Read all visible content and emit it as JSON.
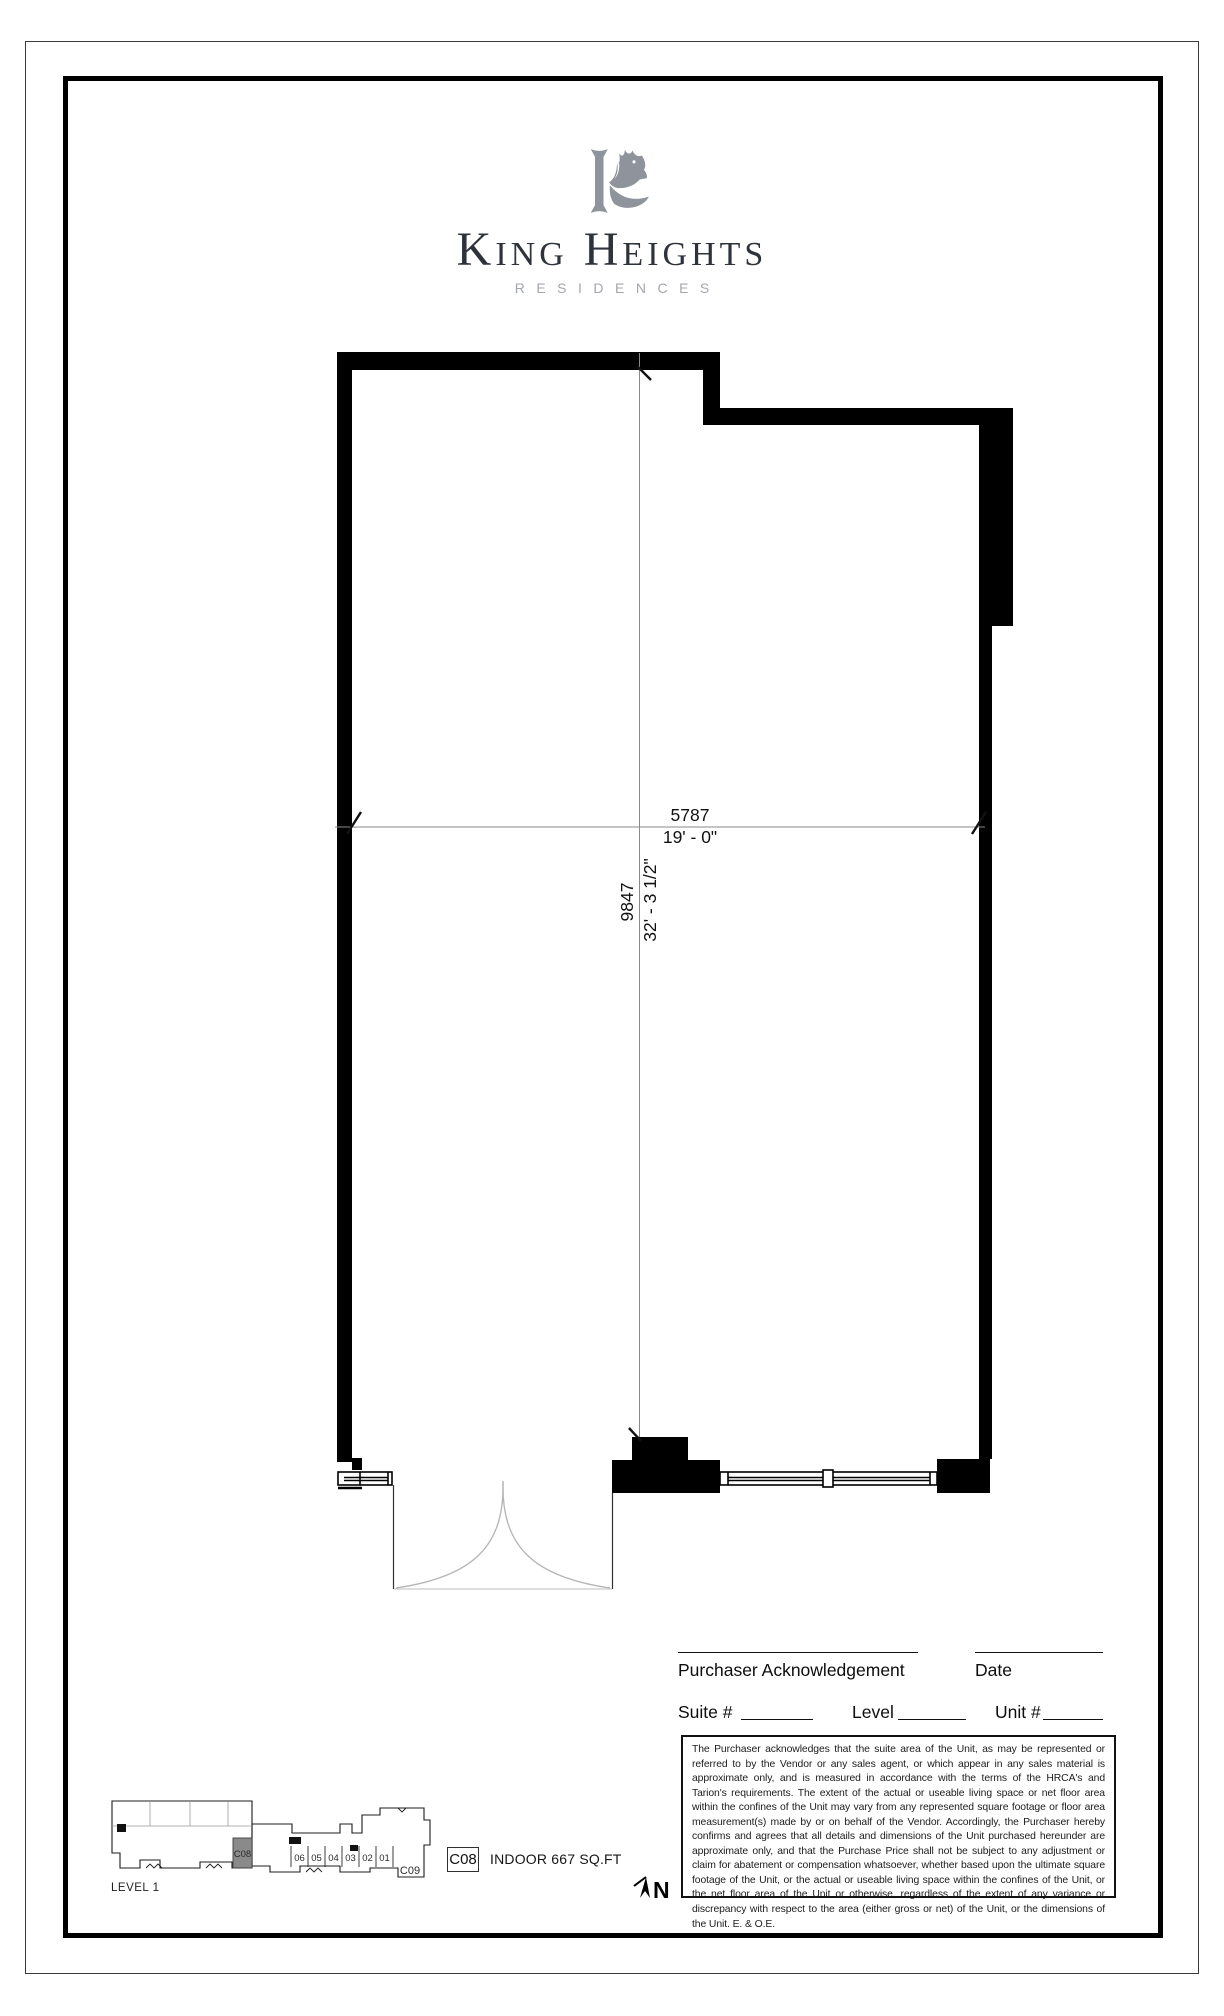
{
  "brand": {
    "name": "King Heights",
    "tagline": "RESIDENCES",
    "logo_icon": "horse-head-k-monogram"
  },
  "floorplan": {
    "dim_horizontal": {
      "mm": "5787",
      "imperial": "19' - 0\""
    },
    "dim_vertical": {
      "mm": "9847",
      "imperial": "32' - 3 1/2\""
    }
  },
  "acknowledgement": {
    "purchaser_label": "Purchaser Acknowledgement",
    "date_label": "Date",
    "suite_label": "Suite #",
    "level_label": "Level",
    "unit_label": "Unit #",
    "disclaimer": "The Purchaser acknowledges that the suite area of the Unit, as may be represented or referred to by the Vendor or any sales agent, or which appear in any sales material is approximate only, and is measured in accordance with the terms of the HRCA's and Tarion's requirements.  The extent of the actual or useable living space or net floor area within the confines of the Unit may vary from any represented square footage or floor area measurement(s) made by or on behalf of the Vendor.  Accordingly, the Purchaser hereby confirms and agrees that all details and dimensions of the Unit purchased hereunder are approximate only, and that the Purchase Price shall not be subject to any adjustment or claim for abatement or compensation whatsoever, whether based upon the ultimate square footage of the Unit, or the actual or useable living space within the confines of the Unit, or the net floor area of the Unit or otherwise, regardless of the extent of any variance or discrepancy with respect to the area (either gross or net) of the Unit, or the dimensions of the Unit. E. & O.E."
  },
  "keyplan": {
    "level_label": "LEVEL 1",
    "highlight_unit": "C08",
    "unit_numbers": [
      "06",
      "05",
      "04",
      "03",
      "02",
      "01"
    ],
    "adjacent_unit": "C09"
  },
  "unit_info": {
    "unit_code": "C08",
    "area_label": "INDOOR 667 SQ.FT"
  },
  "compass": {
    "north_label": "N"
  },
  "colors": {
    "logo_gray": "#8e939c",
    "title_ink": "#2e333b",
    "tagline_gray": "#a3a7ae",
    "wall_black": "#000000",
    "keyplan_highlight": "#8a8a8a"
  }
}
